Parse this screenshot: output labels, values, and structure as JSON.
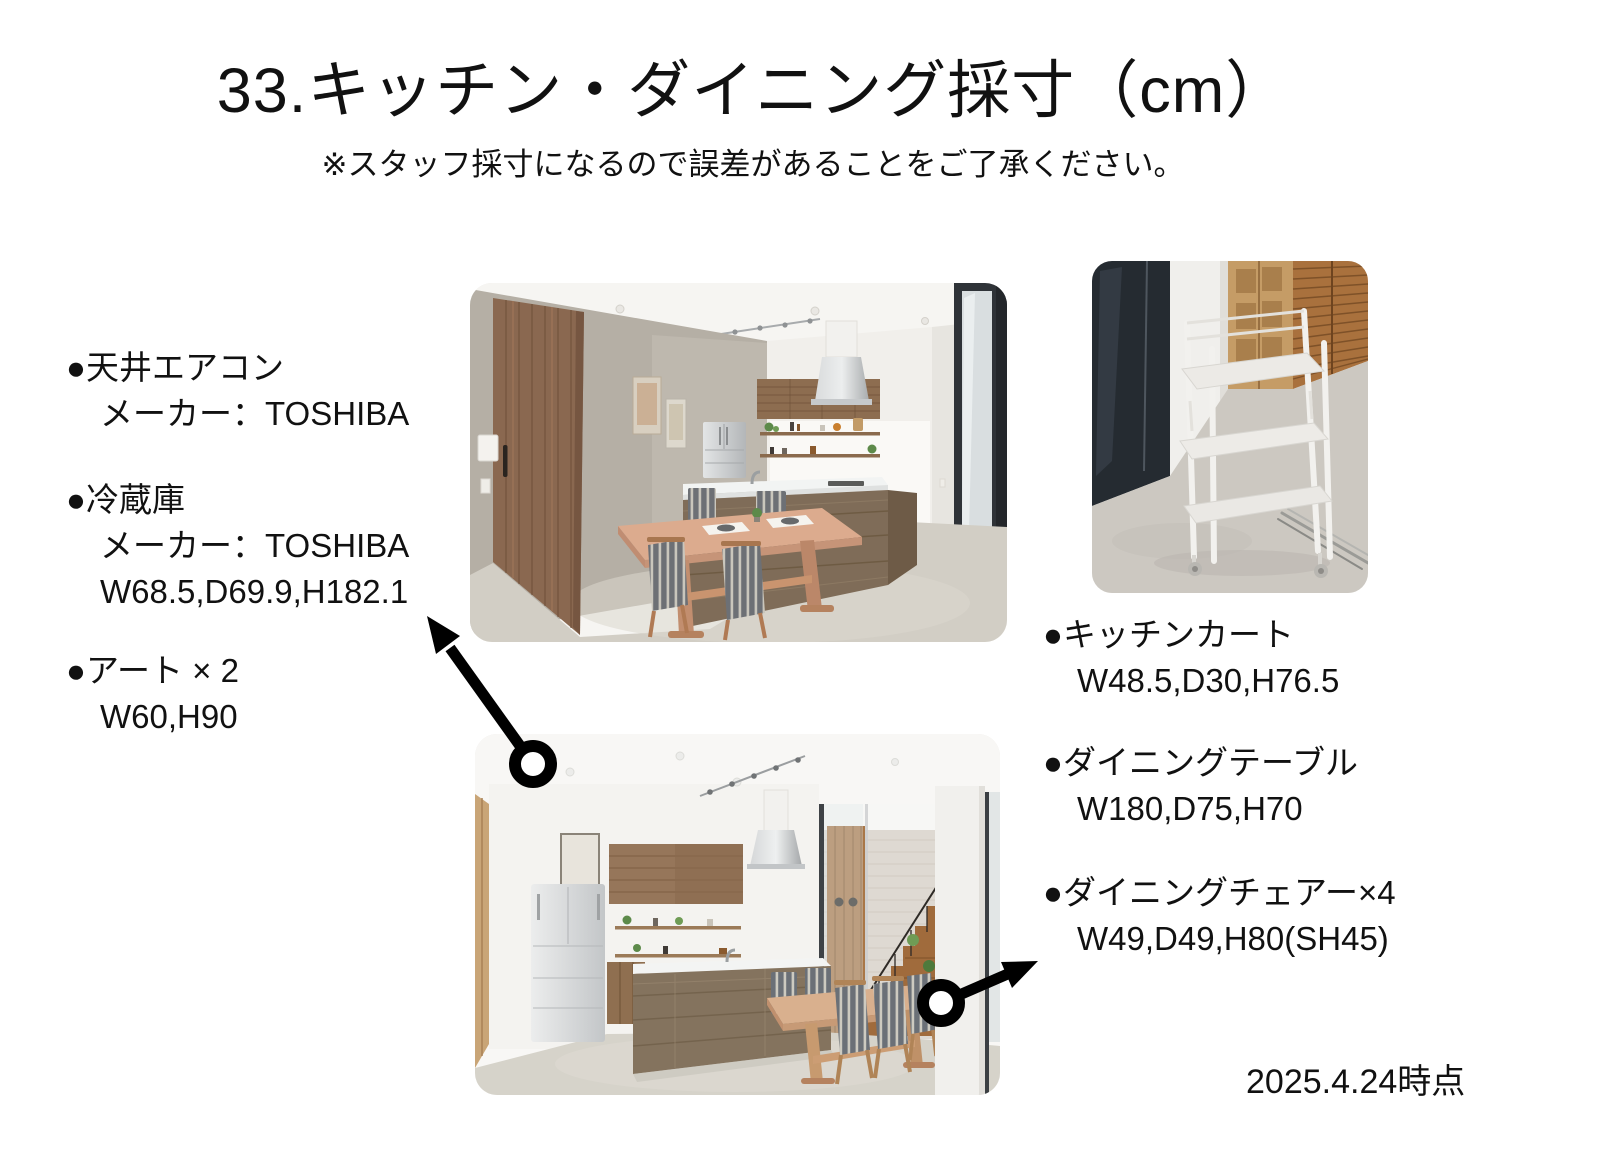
{
  "page": {
    "title": "33.キッチン・ダイニング採寸（cm）",
    "subtitle": "※スタッフ採寸になるので誤差があることをご了承ください。",
    "date_note": "2025.4.24時点"
  },
  "colors": {
    "background": "#ffffff",
    "text": "#111111",
    "arrow": "#000000"
  },
  "items": [
    {
      "bullet": "●",
      "label": "天井エアコン",
      "line1": "メーカー：TOSHIBA"
    },
    {
      "bullet": "●",
      "label": "冷蔵庫",
      "line1": "メーカー：TOSHIBA",
      "line2": "W68.5,D69.9,H182.1"
    },
    {
      "bullet": "●",
      "label": "アート × 2",
      "line1": "W60,H90"
    },
    {
      "bullet": "●",
      "label": "キッチンカート",
      "line1": "W48.5,D30,H76.5"
    },
    {
      "bullet": "●",
      "label": "ダイニングテーブル",
      "line1": "W180,D75,H70"
    },
    {
      "bullet": "●",
      "label": "ダイニングチェアー×4",
      "line1": "W49,D49,H80(SH45)"
    }
  ]
}
